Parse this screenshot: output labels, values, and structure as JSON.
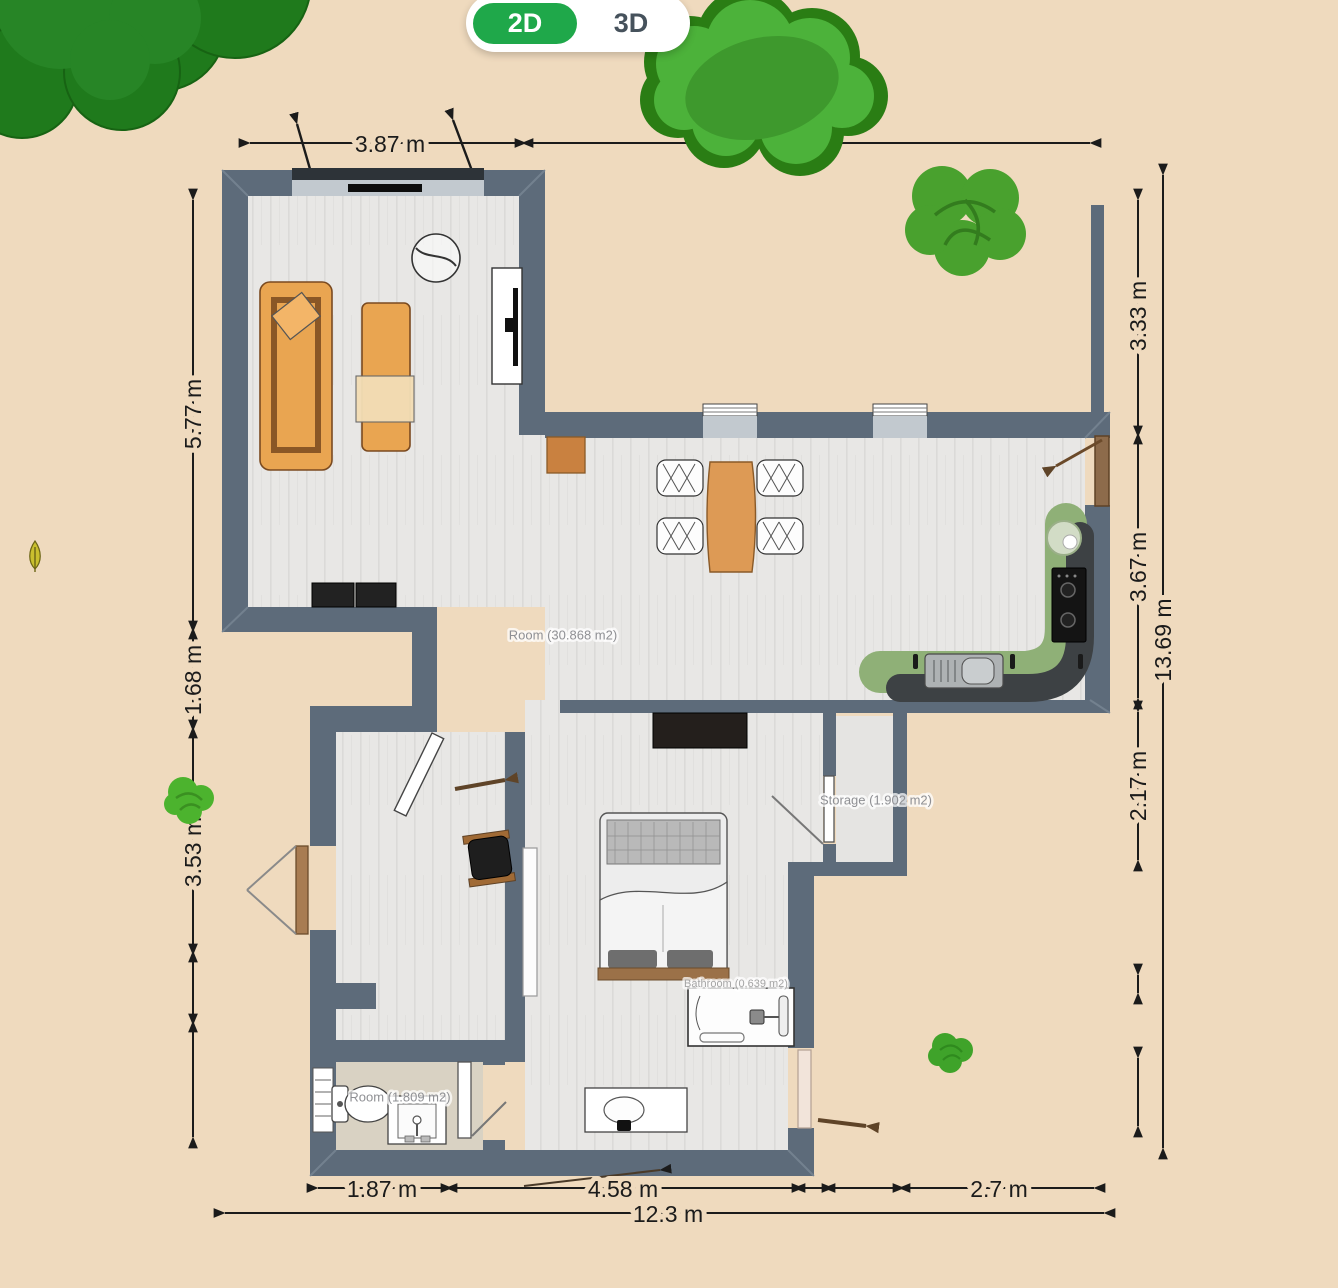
{
  "app": {
    "type": "floor-plan-editor"
  },
  "view_toggle": {
    "active_label": "2D",
    "inactive_label": "3D"
  },
  "dimensions": {
    "top": "3.87 m",
    "left": [
      "5.77 m",
      "1.68 m",
      "3.53 m"
    ],
    "right": [
      "3.33 m",
      "3.67 m",
      "2.17 m"
    ],
    "right_total": "13.69 m",
    "bottom": [
      "1.87 m",
      "4.58 m",
      "2.7 m"
    ],
    "bottom_total": "12.3 m"
  },
  "rooms": {
    "main": "Room (30.868 m2)",
    "storage": "Storage (1.902 m2)",
    "toilet_room": "Room (1.809 m2)",
    "ensuite": "Bathroom (0.639 m2)"
  },
  "colors": {
    "background": "#efdabe",
    "wall": "#5d6b7a",
    "floor": "#e8e7e5",
    "toggle_active": "#1fa84a",
    "furniture_orange": "#e9a551",
    "counter_green": "#8fb077",
    "tree_dark": "#1f7a1c",
    "tree_light": "#4cb23a"
  }
}
